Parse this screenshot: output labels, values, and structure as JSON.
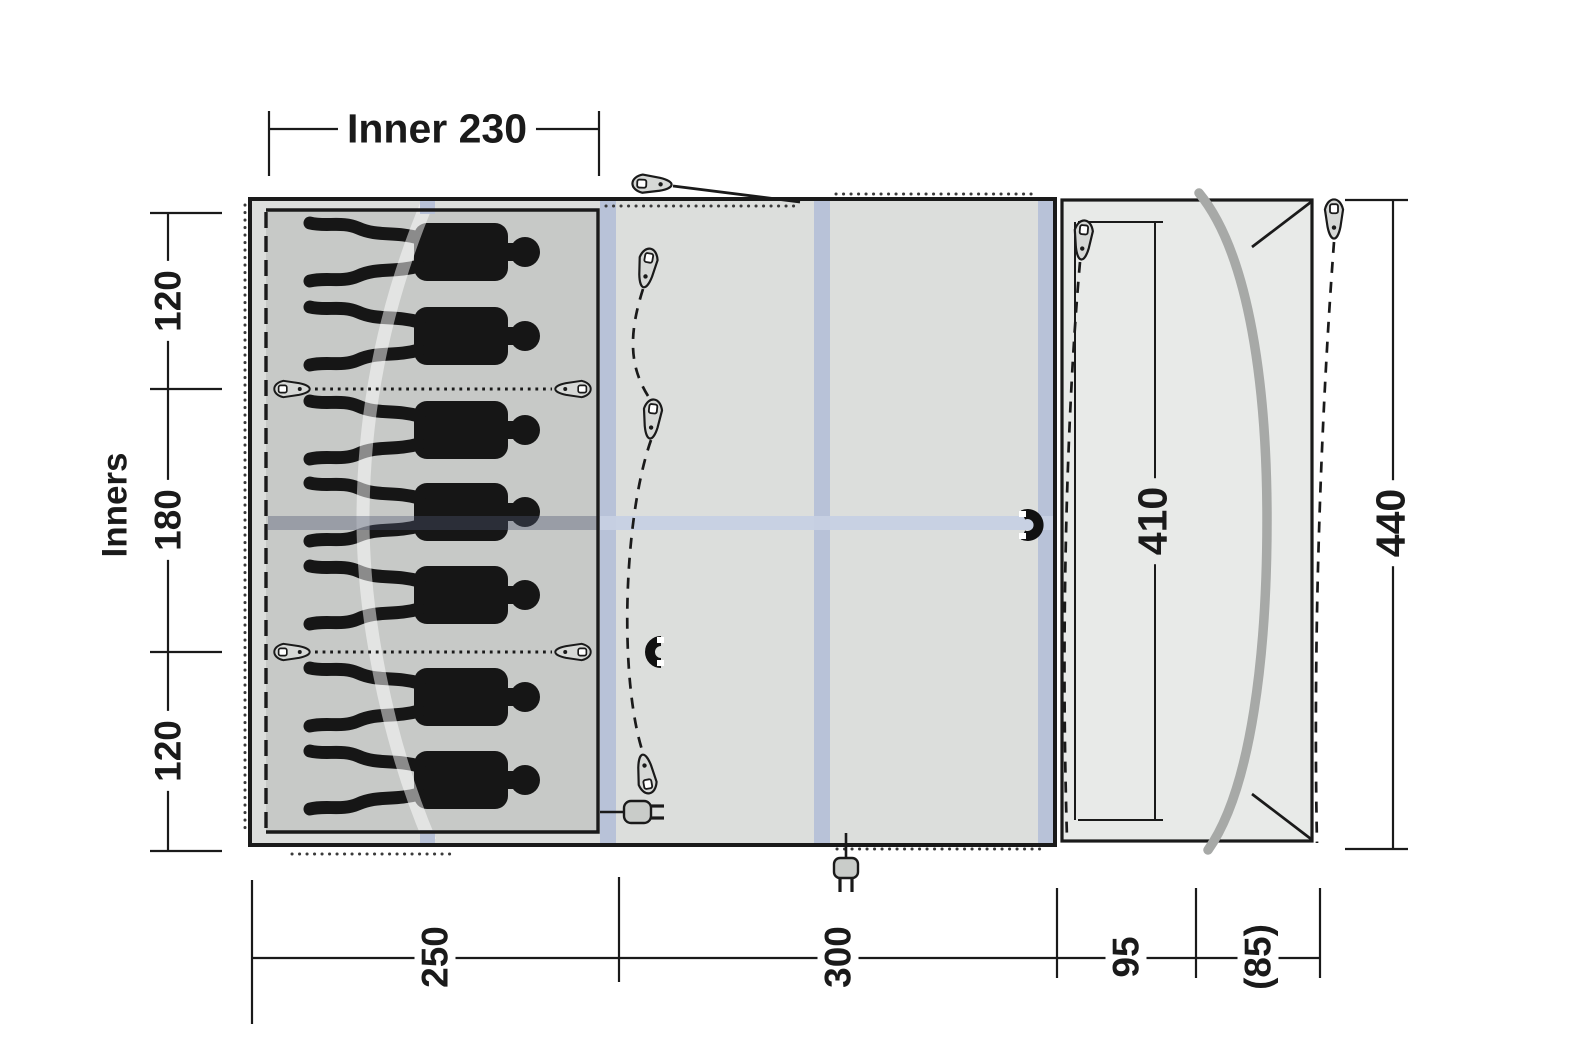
{
  "diagram": {
    "type": "tent-floorplan",
    "labels": {
      "inner_width": "Inner 230",
      "inners_axis": "Inners",
      "left_top": "120",
      "left_mid": "180",
      "left_bottom": "120",
      "porch_depth": "410",
      "total_depth": "440",
      "bottom_sleeping": "250",
      "bottom_living": "300",
      "bottom_front": "95",
      "bottom_canopy": "(85)"
    },
    "sleeper_count": 7,
    "icons": [
      "guy-peg",
      "divider-toggle",
      "magnet",
      "power-plug",
      "pole-arc"
    ],
    "colors": {
      "line": "#1a1a1a",
      "inner_tent_fill": "#c7c9c7",
      "living_fill": "#dcdedc",
      "porch_fill": "#e8eae8",
      "air_tube": "#b8c2d8",
      "roof_band": "#c6d0e3",
      "pole": "#a7a9a7"
    }
  }
}
